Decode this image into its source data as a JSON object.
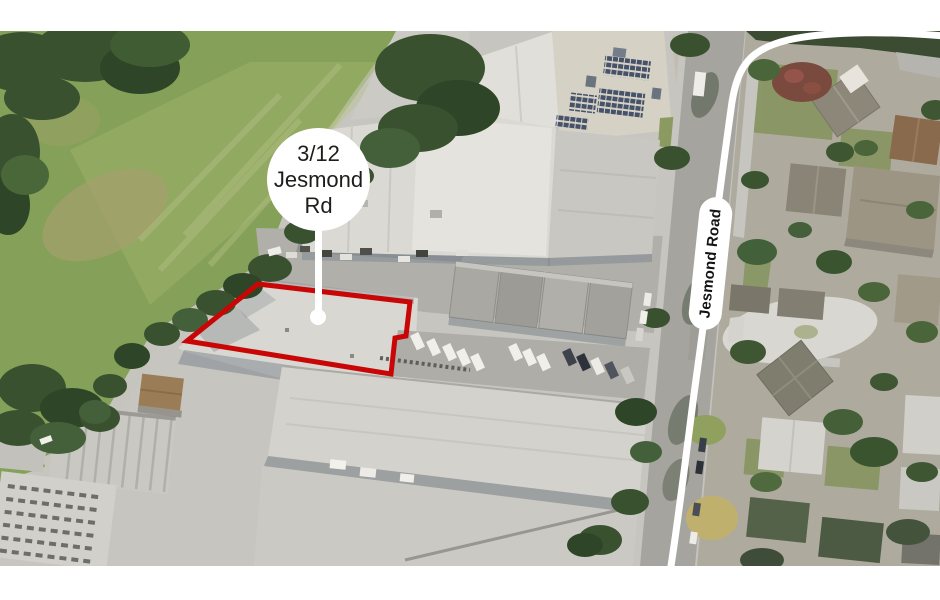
{
  "view": {
    "type": "aerial-map-with-parcel-highlight",
    "letterbox_color": "#ffffff",
    "map_area_top_px": 31,
    "map_area_bottom_px": 566
  },
  "callout": {
    "lines": [
      "3/12",
      "Jesmond",
      "Rd"
    ],
    "bubble_fill": "#ffffff",
    "text_color": "#1d1d1b"
  },
  "road_label": {
    "text": "Jesmond Road",
    "pill_fill": "#ffffff",
    "text_color": "#141414"
  },
  "parcel": {
    "points": "187,341 258,284 410,302 406,336 395,338 391,374",
    "outline_color": "#c90606",
    "stroke_width": 5
  },
  "overlay_route": {
    "path": "M 944,36 C 898,32 832,30 788,40 C 750,49 738,66 732,102 C 725,152 719,196 714,238 C 708,292 701,344 694,394 C 687,448 679,514 671,566",
    "color": "#ffffff",
    "stroke_width": 7
  },
  "map_colors": {
    "industrial_roof": "#d7d6d0",
    "field_green": "#85a058",
    "tree_dark": "#39512f",
    "road_gray": "#a5a49e",
    "residential_base": "#aeab9e",
    "solar_panel": "#46526a",
    "highlight_red": "#c90606"
  }
}
